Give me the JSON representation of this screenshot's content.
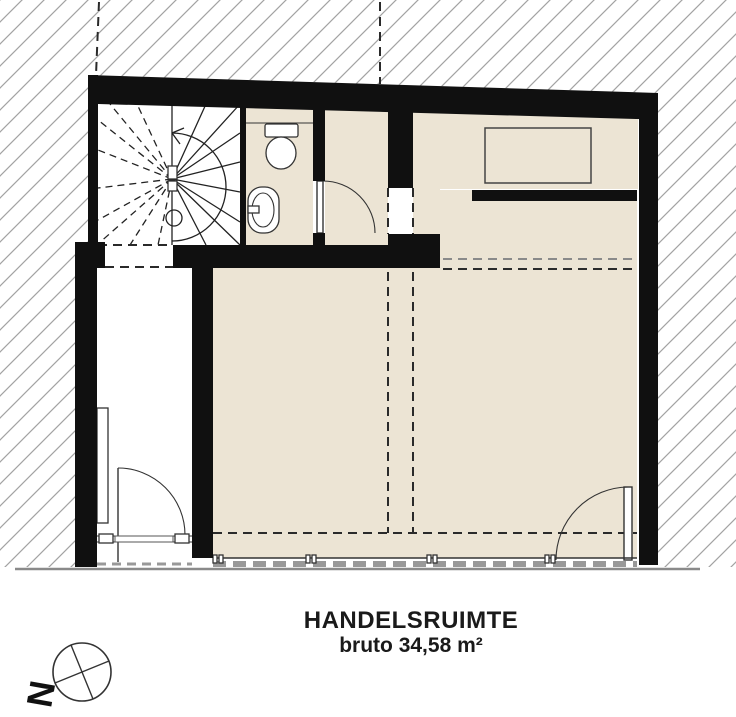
{
  "plan": {
    "label": {
      "line1": "HANDELSRUIMTE",
      "line2": "bruto 34,58 m²"
    },
    "compass": {
      "label": "N"
    },
    "colors": {
      "wall": "#101010",
      "room": "#ece4d4",
      "hatch": "#a3a3a3",
      "stair_line": "#222222",
      "fixture_line": "#333333",
      "dashed_line": "#2a2a2a",
      "sill": "#999999",
      "ground": "#8a8a8a"
    }
  }
}
